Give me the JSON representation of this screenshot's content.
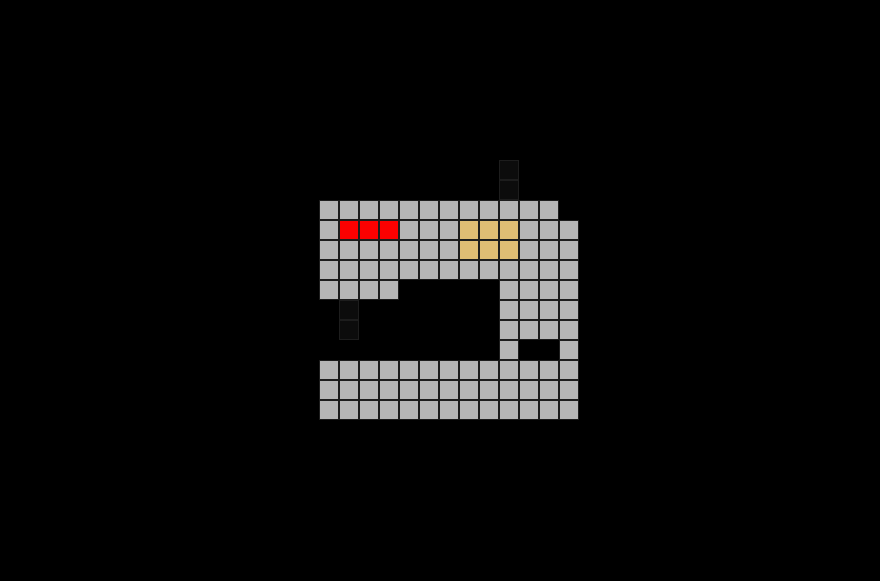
{
  "canvas": {
    "width": 880,
    "height": 581,
    "background_color": "#000000"
  },
  "pixel_grid": {
    "subject": "sewing-machine",
    "origin_x": 319,
    "origin_y": 160,
    "cell_size": 20,
    "columns": 13,
    "grid_line_color": "#1d1d1d",
    "legend": {
      "G": "#b6b6b6",
      "R": "#fb0101",
      "T": "#dfbd74",
      "D": "#0c0c0c",
      ".": null
    },
    "legend_names": {
      "G": "machine-body-gray",
      "R": "button-red",
      "T": "dial-tan",
      "D": "needle-dark",
      ".": "background-black"
    },
    "rows": [
      ".........D...",
      ".........D...",
      "GGGGGGGGGGGG.",
      "GRRRGGGTTTGGG",
      "GGGGGGGTTTGGG",
      "GGGGGGGGGGGGG",
      "GGGG.....GGGG",
      ".D.......GGGG",
      ".D.......GGGG",
      ".........G..G",
      "GGGGGGGGGGGGG",
      "GGGGGGGGGGGGG",
      "GGGGGGGGGGGGG"
    ]
  }
}
